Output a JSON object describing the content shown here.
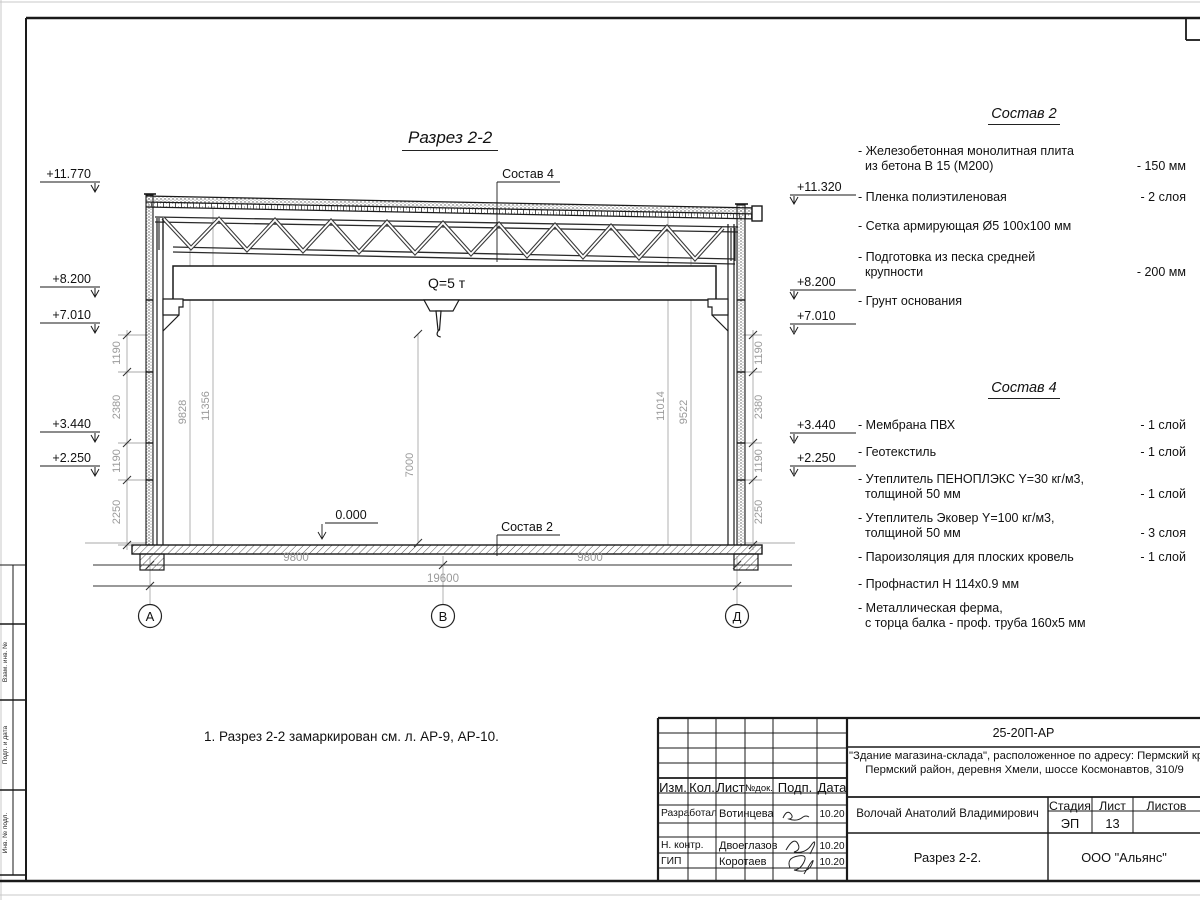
{
  "drawing": {
    "title": "Разрез 2-2",
    "crane_label": "Q=5 т",
    "zero_level": "0.000",
    "sostav4_callout": "Состав 4",
    "sostav2_callout": "Состав 2",
    "elevations_left": [
      "+11.770",
      "+8.200",
      "+7.010",
      "+3.440",
      "+2.250"
    ],
    "elevations_right": [
      "+11.320",
      "+8.200",
      "+7.010",
      "+3.440",
      "+2.250"
    ],
    "dims_left": [
      "1190",
      "2380",
      "1190",
      "2250"
    ],
    "dims_right": [
      "1190",
      "2380",
      "1190",
      "2250"
    ],
    "dims_interior": {
      "d9828": "9828",
      "d11356": "11356",
      "d7000": "7000",
      "d11014": "11014",
      "d9522": "9522"
    },
    "dims_bottom": {
      "left": "9800",
      "right": "9800",
      "total": "19600"
    },
    "grid_axes": {
      "a": "А",
      "b": "В",
      "d": "Д"
    }
  },
  "note": "1. Разрез 2-2 замаркирован см. л. АР-9, АР-10.",
  "sostav2": {
    "title": "Состав 2",
    "items": [
      {
        "l1": "- Железобетонная  монолитная плита",
        "l2": "из бетона В 15 (М200)",
        "value": "- 150 мм"
      },
      {
        "l1": "- Пленка полиэтиленовая",
        "value": "-  2 слоя"
      },
      {
        "l1": "- Сетка армирующая Ø5 100х100 мм",
        "value": ""
      },
      {
        "l1": "- Подготовка из песка средней",
        "l2": "крупности",
        "value": "- 200 мм"
      },
      {
        "l1": "- Грунт основания",
        "value": ""
      }
    ]
  },
  "sostav4": {
    "title": "Состав 4",
    "items": [
      {
        "l1": "- Мембрана ПВХ",
        "value": "- 1 слой"
      },
      {
        "l1": "- Геотекстиль",
        "value": "- 1 слой"
      },
      {
        "l1": "- Утеплитель ПЕНОПЛЭКС Y=30 кг/м3,",
        "l2": "толщиной 50 мм",
        "value": "- 1 слой"
      },
      {
        "l1": "- Утеплитель Эковер Y=100 кг/м3,",
        "l2": "толщиной 50 мм",
        "value": "- 3 слоя"
      },
      {
        "l1": "- Пароизоляция для плоских кровель",
        "value": "- 1 слой"
      },
      {
        "l1": "- Профнастил Н 114х0.9 мм",
        "value": ""
      },
      {
        "l1": "- Металлическая ферма,",
        "l2": "с торца балка - проф. труба 160х5 мм",
        "value": ""
      }
    ]
  },
  "titleblock": {
    "doc_number": "25-20П-АР",
    "description_line1": "\"Здание магазина-склада\", расположенное по адресу: Пермский край,",
    "description_line2": "Пермский район, деревня Хмели, шоссе Космонавтов, 310/9",
    "col_izm": "Изм.",
    "col_kol": "Кол.",
    "col_list": "Лист",
    "col_ndok": "№док.",
    "col_podp": "Подп.",
    "col_data": "Дата",
    "row1_role": "Разработал",
    "row1_name": "Вотинцева",
    "row1_date": "10.20",
    "row2_role": "Н. контр.",
    "row2_name": "Двоеглазов",
    "row2_date": "10.20",
    "row3_role": "ГИП",
    "row3_name": "Коротаев",
    "row3_date": "10.20",
    "chief": "Волочай Анатолий Владимирович",
    "stage_label": "Стадия",
    "sheet_label": "Лист",
    "sheets_label": "Листов",
    "stage": "ЭП",
    "sheet": "13",
    "drawing_name": "Разрез 2-2.",
    "company": "ООО \"Альянс\""
  },
  "margin": {
    "field1": "Взам. инв. №",
    "field2": "Подп. и дата",
    "field3": "Инв. № подл."
  }
}
